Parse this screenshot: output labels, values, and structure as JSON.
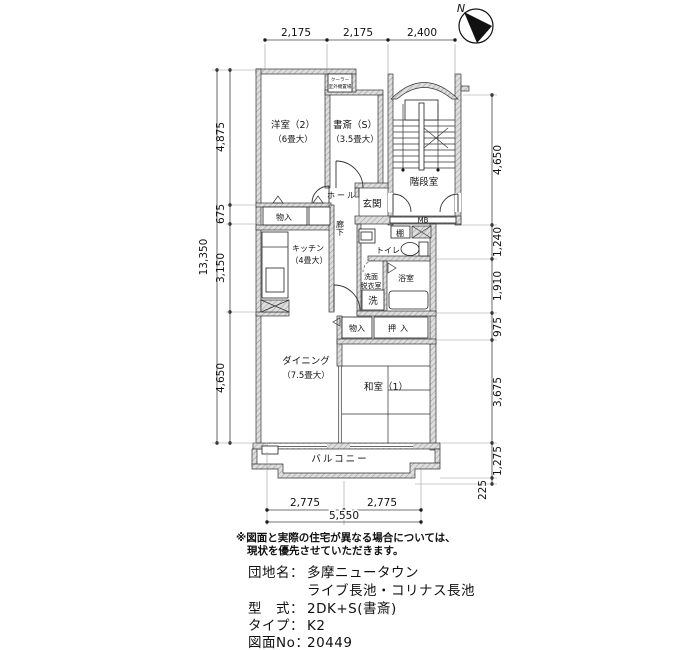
{
  "compass": {
    "north_label": "N"
  },
  "dimensions": {
    "top": [
      "2,175",
      "2,175",
      "2,400"
    ],
    "left_total": "13,350",
    "left": [
      "4,875",
      "675",
      "3,150",
      "4,650"
    ],
    "right": [
      "4,650",
      "1,240",
      "1,910",
      "975",
      "3,675",
      "1,275",
      "225"
    ],
    "bottom": [
      "2,775",
      "2,775"
    ],
    "bottom_total": "5,550"
  },
  "rooms": {
    "western_room": {
      "name": "洋室（2）",
      "size": "（6畳大）"
    },
    "study": {
      "name": "書斎（S）",
      "size": "（3.5畳大）"
    },
    "stairwell": {
      "name": "階段室"
    },
    "hall": {
      "name": "ホール"
    },
    "entrance": {
      "name": "玄関"
    },
    "corridor": {
      "name": "廊下"
    },
    "kitchen": {
      "name": "キッチン",
      "size": "（4畳大）"
    },
    "toilet": {
      "name": "トイレ"
    },
    "washroom": {
      "name1": "洗面",
      "name2": "脱衣室"
    },
    "bathroom": {
      "name": "浴室"
    },
    "dining": {
      "name": "ダイニング",
      "size": "（7.5畳大）"
    },
    "japanese_room": {
      "name": "和室（1）"
    },
    "balcony": {
      "name": "バルコニー"
    }
  },
  "fixtures": {
    "closet_west": "物入",
    "closet_mid": "物入",
    "oshiire": "押入",
    "shelf": "棚",
    "washer": "洗",
    "meter_box": "MB",
    "aircon_line1": "クーラー",
    "aircon_line2": "室外機置場"
  },
  "notes": {
    "line1": "※図面と実際の住宅が異なる場合については、",
    "line2": "現状を優先させていただきます。"
  },
  "title_block": {
    "estate_label": "団地名：",
    "estate_value": "多摩ニュータウン",
    "estate_value2": "ライブ長池・コリナス長池",
    "layout_label": "型　式：",
    "layout_value": "2DK+S(書斎)",
    "type_label": "タイプ：",
    "type_value": "K2",
    "drawing_no_label": "図面No：",
    "drawing_no_value": "20449"
  }
}
